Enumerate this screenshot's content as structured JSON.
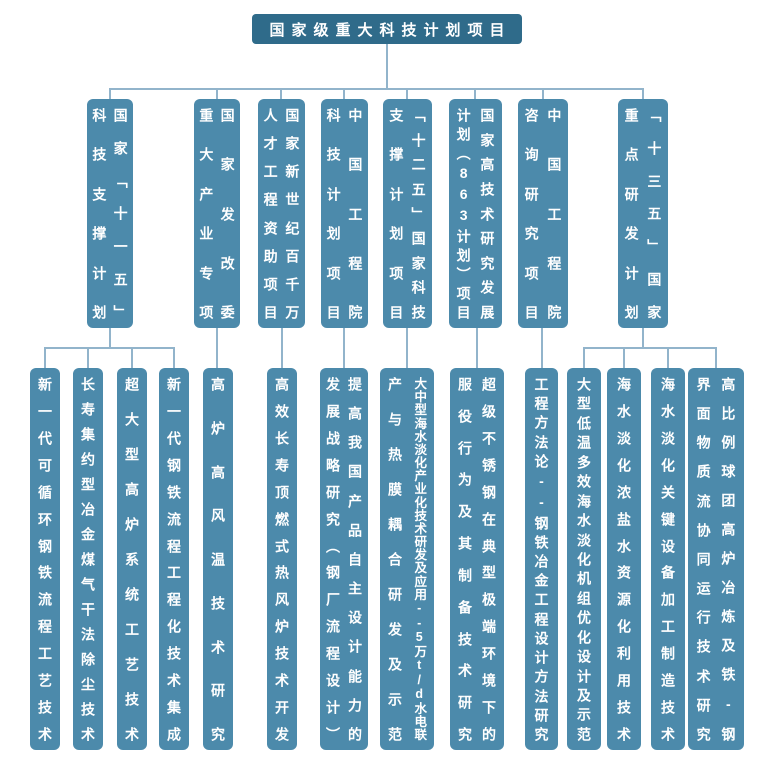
{
  "palette": {
    "root_bg": "#2F6B8A",
    "node_bg": "#4C8AAB",
    "line": "#92B4CB",
    "text": "#FFFFFF",
    "page_bg": "#FFFFFF"
  },
  "root": {
    "label": "国家级重大科技计划项目"
  },
  "branches": [
    {
      "cols": [
        "国家「十一五」",
        "科技支撑计划"
      ],
      "children": [
        {
          "cols": [
            "新一代可循环钢铁流程工艺技术"
          ]
        },
        {
          "cols": [
            "长寿集约型冶金煤气干法除尘技术"
          ]
        },
        {
          "cols": [
            "超大型高炉系统工艺技术"
          ]
        },
        {
          "cols": [
            "新一代钢铁流程工程化技术集成"
          ]
        }
      ]
    },
    {
      "cols": [
        "国家发改委",
        "重大产业专项"
      ],
      "children": [
        {
          "cols": [
            "高炉高风温技术研究"
          ]
        }
      ]
    },
    {
      "cols": [
        "国家新世纪百千万",
        "人才工程资助项目"
      ],
      "children": [
        {
          "cols": [
            "高效长寿顶燃式热风炉技术开发"
          ]
        }
      ]
    },
    {
      "cols": [
        "中国工程院",
        "科技计划项目"
      ],
      "children": [
        {
          "cols": [
            "提高我国产品自主设计能力的",
            "发展战略研究（钢厂流程设计）"
          ]
        }
      ]
    },
    {
      "cols": [
        "「十二五」国家科技",
        "支撑计划项目"
      ],
      "children": [
        {
          "cols": [
            "大中型海水淡化产业化技术研发及应用--5万t/d水电联",
            "产与热膜耦合研发及示范"
          ]
        }
      ]
    },
    {
      "cols": [
        "国家高技术研究发展",
        "计划（863计划）项目"
      ],
      "children": [
        {
          "cols": [
            "超级不锈钢在典型极端环境下的",
            "服役行为及其制备技术研究"
          ]
        }
      ]
    },
    {
      "cols": [
        "中国工程院",
        "咨询研究项目"
      ],
      "children": [
        {
          "cols": [
            "工程方法论--钢铁冶金工程设计方法研究"
          ]
        }
      ]
    },
    {
      "cols": [
        "「十三五」国家",
        "重点研发计划"
      ],
      "children": [
        {
          "cols": [
            "大型低温多效海水淡化机组优化设计及示范"
          ]
        },
        {
          "cols": [
            "海水淡化浓盐水资源化利用技术"
          ]
        },
        {
          "cols": [
            "海水淡化关键设备加工制造技术"
          ]
        },
        {
          "cols": [
            "高比例球团高炉冶炼及铁-钢",
            "界面物质流协同运行技术研究"
          ]
        }
      ]
    }
  ]
}
